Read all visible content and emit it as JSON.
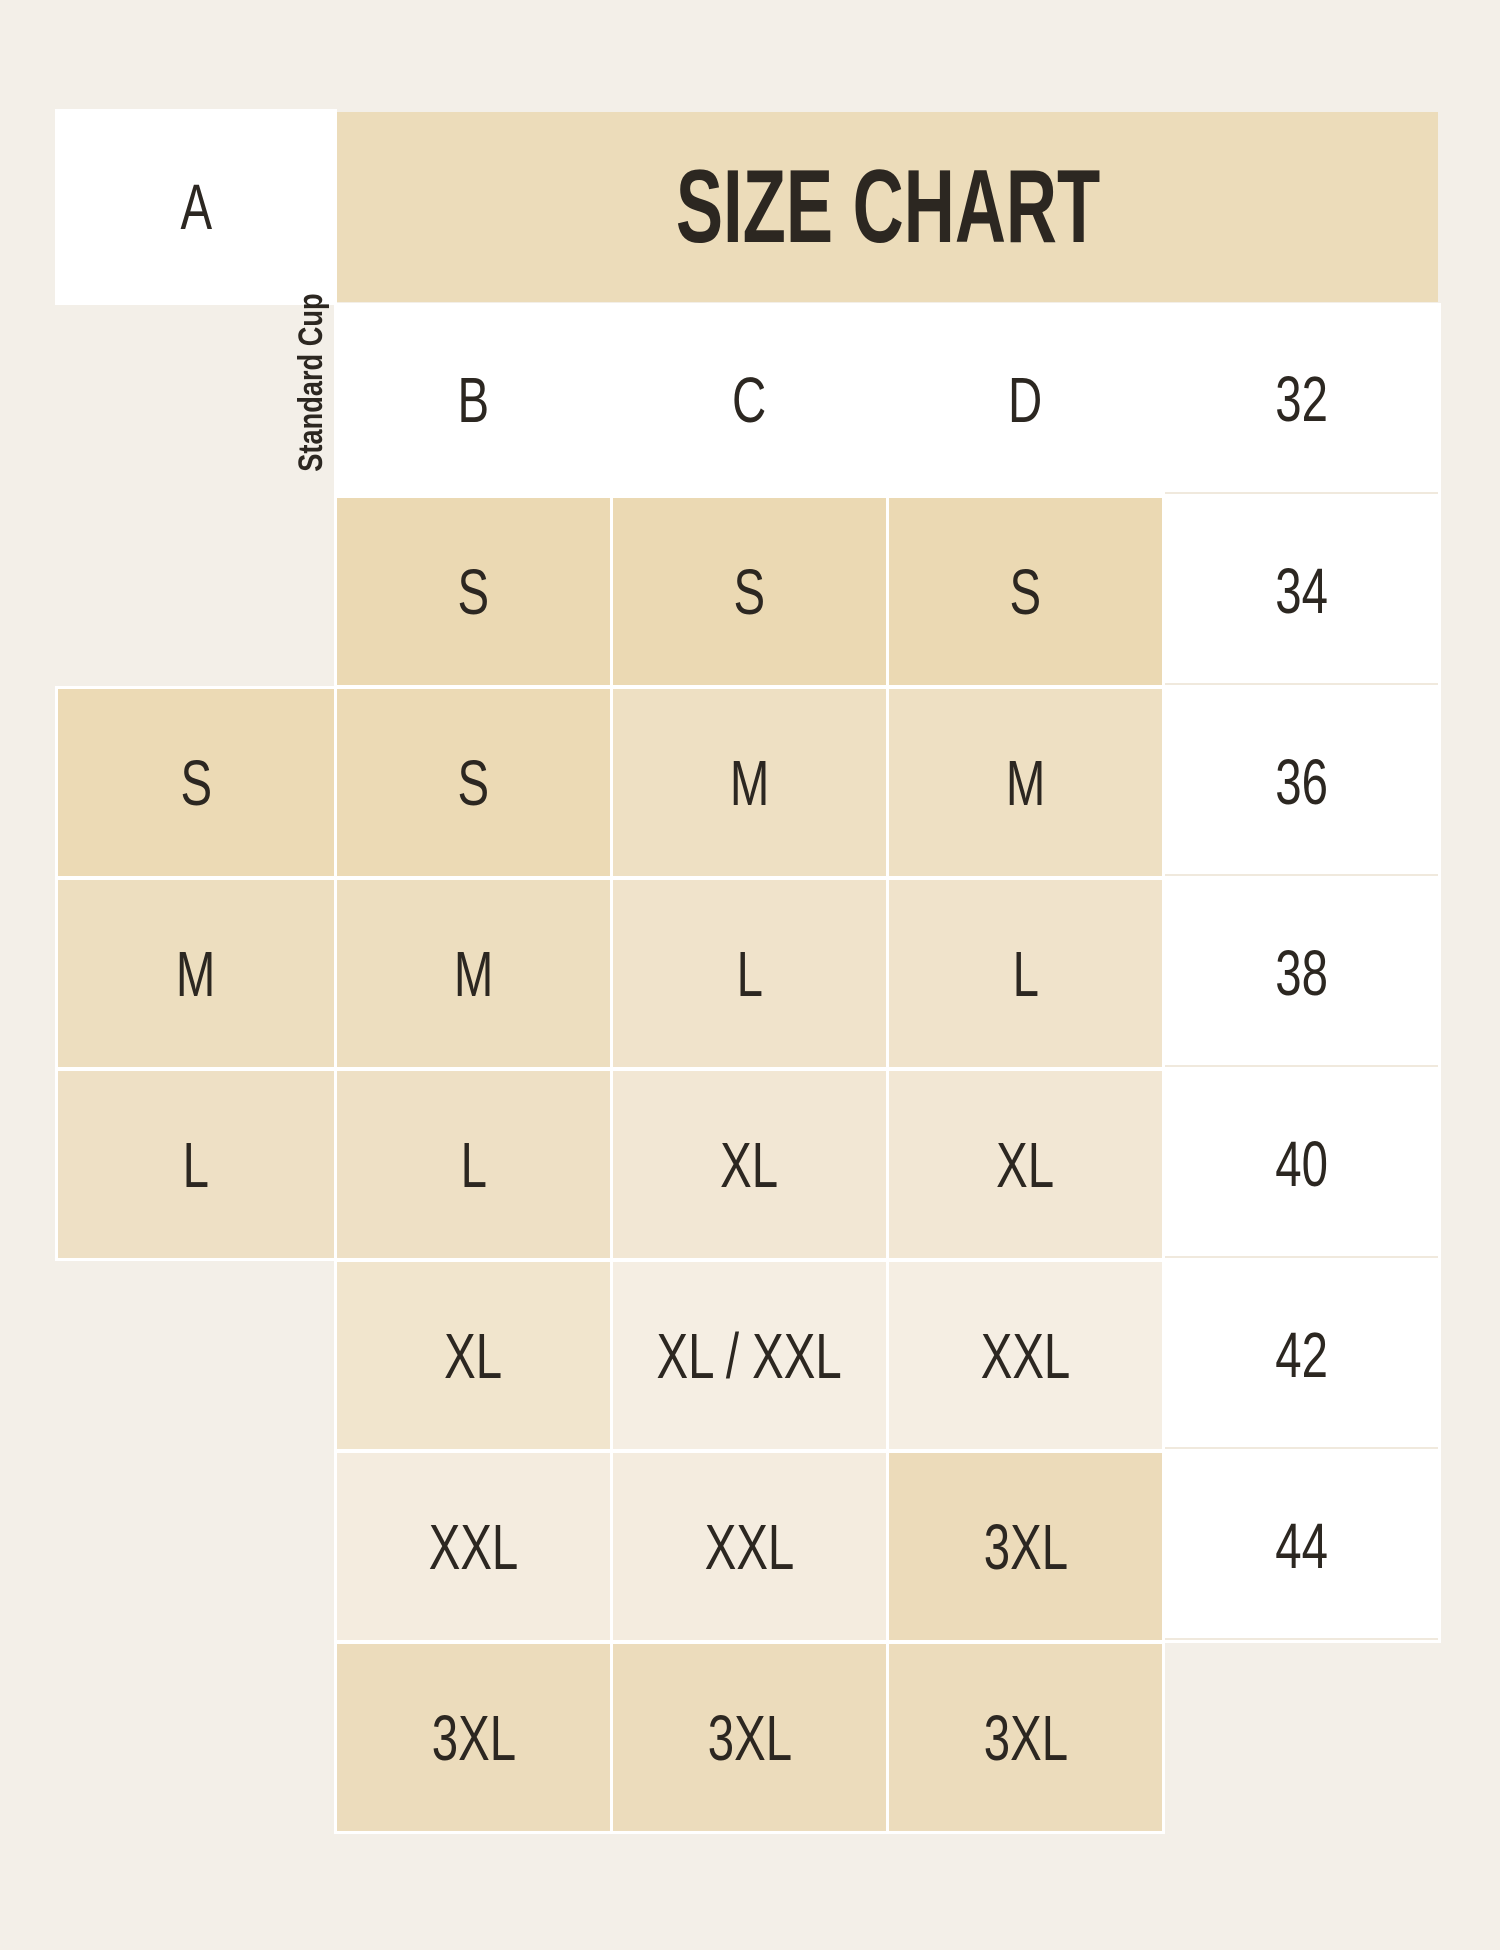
{
  "palette": {
    "page-bg": "#f3efe8",
    "band": "#ecdcba",
    "ink": "#2c2721",
    "cell-white": "#ffffff",
    "halo": "#ffffff",
    "hairline": "#f0e9dd"
  },
  "title": {
    "text": "SIZE CHART"
  },
  "axis_label": "Standard Cup",
  "table": {
    "columns": [
      "A",
      "B",
      "C",
      "D"
    ],
    "rows": [
      {
        "label": "32",
        "cells": [
          {
            "text": "",
            "bg": ""
          },
          {
            "text": "S",
            "bg": "#ebd9b3"
          },
          {
            "text": "S",
            "bg": "#ebd9b3"
          },
          {
            "text": "S",
            "bg": "#ebd9b3"
          }
        ]
      },
      {
        "label": "34",
        "cells": [
          {
            "text": "S",
            "bg": "#ecdab5"
          },
          {
            "text": "S",
            "bg": "#ecdab5"
          },
          {
            "text": "M",
            "bg": "#eee0c3"
          },
          {
            "text": "M",
            "bg": "#eee0c3"
          }
        ]
      },
      {
        "label": "36",
        "cells": [
          {
            "text": "M",
            "bg": "#eddebf"
          },
          {
            "text": "M",
            "bg": "#eddebf"
          },
          {
            "text": "L",
            "bg": "#f0e3cb"
          },
          {
            "text": "L",
            "bg": "#f0e3cb"
          }
        ]
      },
      {
        "label": "38",
        "cells": [
          {
            "text": "L",
            "bg": "#eee0c5"
          },
          {
            "text": "L",
            "bg": "#eee0c5"
          },
          {
            "text": "XL",
            "bg": "#f2e7d4"
          },
          {
            "text": "XL",
            "bg": "#f2e7d4"
          }
        ]
      },
      {
        "label": "40",
        "cells": [
          {
            "text": "",
            "bg": ""
          },
          {
            "text": "XL",
            "bg": "#f1e5cd"
          },
          {
            "text": "XL / XXL",
            "bg": "#f5eee3"
          },
          {
            "text": "XXL",
            "bg": "#f5eee3"
          }
        ]
      },
      {
        "label": "42",
        "cells": [
          {
            "text": "",
            "bg": ""
          },
          {
            "text": "XXL",
            "bg": "#f4ecdf"
          },
          {
            "text": "XXL",
            "bg": "#f4ecdf"
          },
          {
            "text": "3XL",
            "bg": "#ecdbba"
          }
        ]
      },
      {
        "label": "44",
        "cells": [
          {
            "text": "",
            "bg": ""
          },
          {
            "text": "3XL",
            "bg": "#ecdcbc"
          },
          {
            "text": "3XL",
            "bg": "#ecdcbc"
          },
          {
            "text": "3XL",
            "bg": "#ecdcbc"
          }
        ]
      }
    ]
  },
  "chart_data": {
    "type": "table",
    "title": "SIZE CHART",
    "row_header_label": "Standard Cup",
    "columns": [
      "A",
      "B",
      "C",
      "D"
    ],
    "row_labels": [
      "32",
      "34",
      "36",
      "38",
      "40",
      "42",
      "44"
    ],
    "rows": [
      [
        "",
        "S",
        "S",
        "S"
      ],
      [
        "S",
        "S",
        "M",
        "M"
      ],
      [
        "M",
        "M",
        "L",
        "L"
      ],
      [
        "L",
        "L",
        "XL",
        "XL"
      ],
      [
        "",
        "XL",
        "XL / XXL",
        "XXL"
      ],
      [
        "",
        "XXL",
        "XXL",
        "3XL"
      ],
      [
        "",
        "3XL",
        "3XL",
        "3XL"
      ]
    ]
  }
}
